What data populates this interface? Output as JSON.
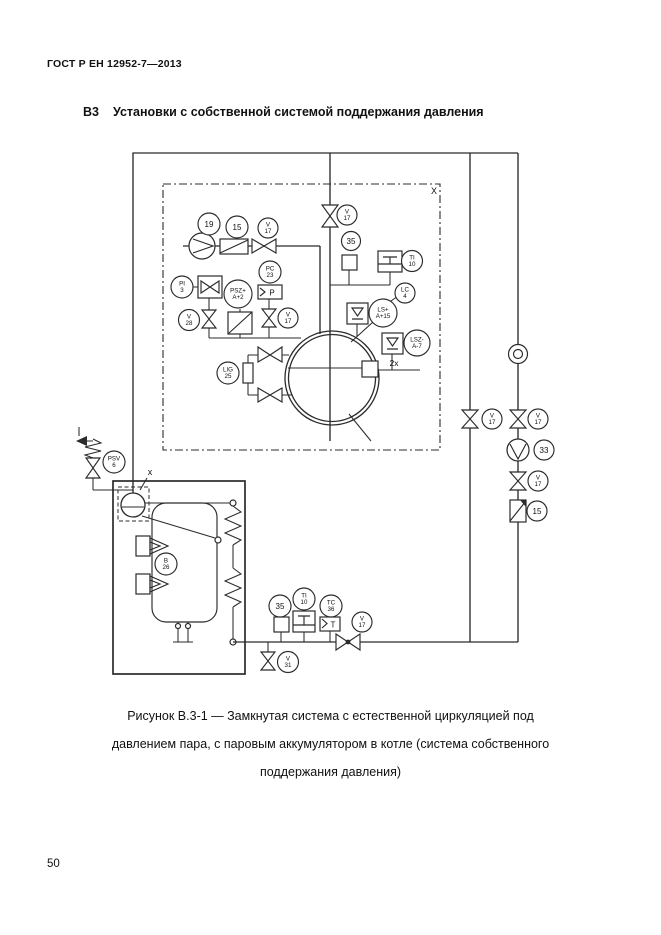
{
  "page": {
    "header": "ГОСТ Р ЕН 12952-7—2013",
    "section_number": "В3",
    "section_title": "Установки с собственной системой поддержания давления",
    "caption_line1": "Рисунок В.3-1 — Замкнутая система с естественной циркуляцией под",
    "caption_line2": "давлением пара, с паровым аккумулятором в котле (система собственного",
    "caption_line3": "поддержания давления)",
    "page_number": "50"
  },
  "diagram": {
    "bubbles": [
      {
        "name": "pump-19",
        "x": 209,
        "y": 224,
        "r": 11,
        "lines": [
          "19"
        ]
      },
      {
        "name": "strainer-15-feed",
        "x": 237,
        "y": 227,
        "r": 11,
        "lines": [
          "15"
        ]
      },
      {
        "name": "valve-v17-feed",
        "x": 268,
        "y": 228,
        "r": 10,
        "lines": [
          "V",
          "17"
        ]
      },
      {
        "name": "valve-v17-steam",
        "x": 347,
        "y": 215,
        "r": 10,
        "lines": [
          "V",
          "17"
        ]
      },
      {
        "name": "sampler-35-top",
        "x": 351,
        "y": 241,
        "r": 9.5,
        "lines": [
          "35"
        ]
      },
      {
        "name": "thermometer-ti-10-top",
        "x": 412,
        "y": 261,
        "r": 10.5,
        "lines": [
          "TI",
          "10"
        ]
      },
      {
        "name": "gauge-pi-3",
        "x": 182,
        "y": 287,
        "r": 11,
        "lines": [
          "PI",
          "3"
        ]
      },
      {
        "name": "pressure-limiter-psz",
        "x": 238,
        "y": 294,
        "r": 14,
        "lines": [
          "PSZ+",
          "A+2"
        ]
      },
      {
        "name": "pressure-controller-pc-23",
        "x": 270,
        "y": 272,
        "r": 11,
        "lines": [
          "PC",
          "23"
        ]
      },
      {
        "name": "valve-v28",
        "x": 189,
        "y": 320,
        "r": 10.5,
        "lines": [
          "V",
          "28"
        ]
      },
      {
        "name": "valve-v17-pc",
        "x": 288,
        "y": 318,
        "r": 10,
        "lines": [
          "V",
          "17"
        ]
      },
      {
        "name": "level-gauge-lig-25",
        "x": 228,
        "y": 373,
        "r": 11,
        "lines": [
          "LIG",
          "25"
        ]
      },
      {
        "name": "level-switch-ls-a15",
        "x": 383,
        "y": 313,
        "r": 14,
        "lines": [
          "LS+",
          "A+15"
        ]
      },
      {
        "name": "level-controller-lc-4",
        "x": 405,
        "y": 293,
        "r": 10,
        "lines": [
          "LC",
          "4"
        ]
      },
      {
        "name": "level-limiter-lsz-a7",
        "x": 417,
        "y": 343,
        "r": 13,
        "lines": [
          "LSZ-",
          "A-7"
        ]
      },
      {
        "name": "safety-valve-psv-6",
        "x": 114,
        "y": 462,
        "r": 11,
        "lines": [
          "PSV",
          "6"
        ]
      },
      {
        "name": "burner-b-26",
        "x": 166,
        "y": 564,
        "r": 11,
        "lines": [
          "B",
          "26"
        ]
      },
      {
        "name": "sampler-35-bottom",
        "x": 280,
        "y": 606,
        "r": 11,
        "lines": [
          "35"
        ]
      },
      {
        "name": "thermometer-ti-10-bottom",
        "x": 304,
        "y": 599,
        "r": 11,
        "lines": [
          "TI",
          "10"
        ]
      },
      {
        "name": "temp-controller-tc-36",
        "x": 331,
        "y": 606,
        "r": 11,
        "lines": [
          "TC",
          "36"
        ]
      },
      {
        "name": "valve-v17-return",
        "x": 362,
        "y": 622,
        "r": 10,
        "lines": [
          "V",
          "17"
        ]
      },
      {
        "name": "valve-v31-drain",
        "x": 288,
        "y": 662,
        "r": 10.5,
        "lines": [
          "V",
          "31"
        ]
      },
      {
        "name": "valve-v17-bypass",
        "x": 492,
        "y": 419,
        "r": 10,
        "lines": [
          "V",
          "17"
        ]
      },
      {
        "name": "valve-v17-circ-upper",
        "x": 538,
        "y": 419,
        "r": 10,
        "lines": [
          "V",
          "17"
        ]
      },
      {
        "name": "circulation-pump-33",
        "x": 544,
        "y": 450,
        "r": 10,
        "lines": [
          "33"
        ]
      },
      {
        "name": "valve-v17-circ-lower",
        "x": 538,
        "y": 481,
        "r": 10,
        "lines": [
          "V",
          "17"
        ]
      },
      {
        "name": "strainer-15-circ",
        "x": 537,
        "y": 511,
        "r": 10,
        "lines": [
          "15"
        ]
      }
    ],
    "labels": [
      {
        "name": "system-boundary-label",
        "x": 434,
        "y": 194,
        "t": "X",
        "fs": 9
      },
      {
        "name": "boiler-drum-label",
        "x": 150,
        "y": 475,
        "t": "x",
        "fs": 9
      },
      {
        "name": "dual-connection-label",
        "x": 394,
        "y": 366,
        "t": "2x",
        "fs": 8.5
      },
      {
        "name": "pc-box-letter",
        "x": 272,
        "y": 295.5,
        "t": "P",
        "fs": 8
      },
      {
        "name": "tc-box-letter",
        "x": 333,
        "y": 627.5,
        "t": "T",
        "fs": 8
      }
    ]
  }
}
